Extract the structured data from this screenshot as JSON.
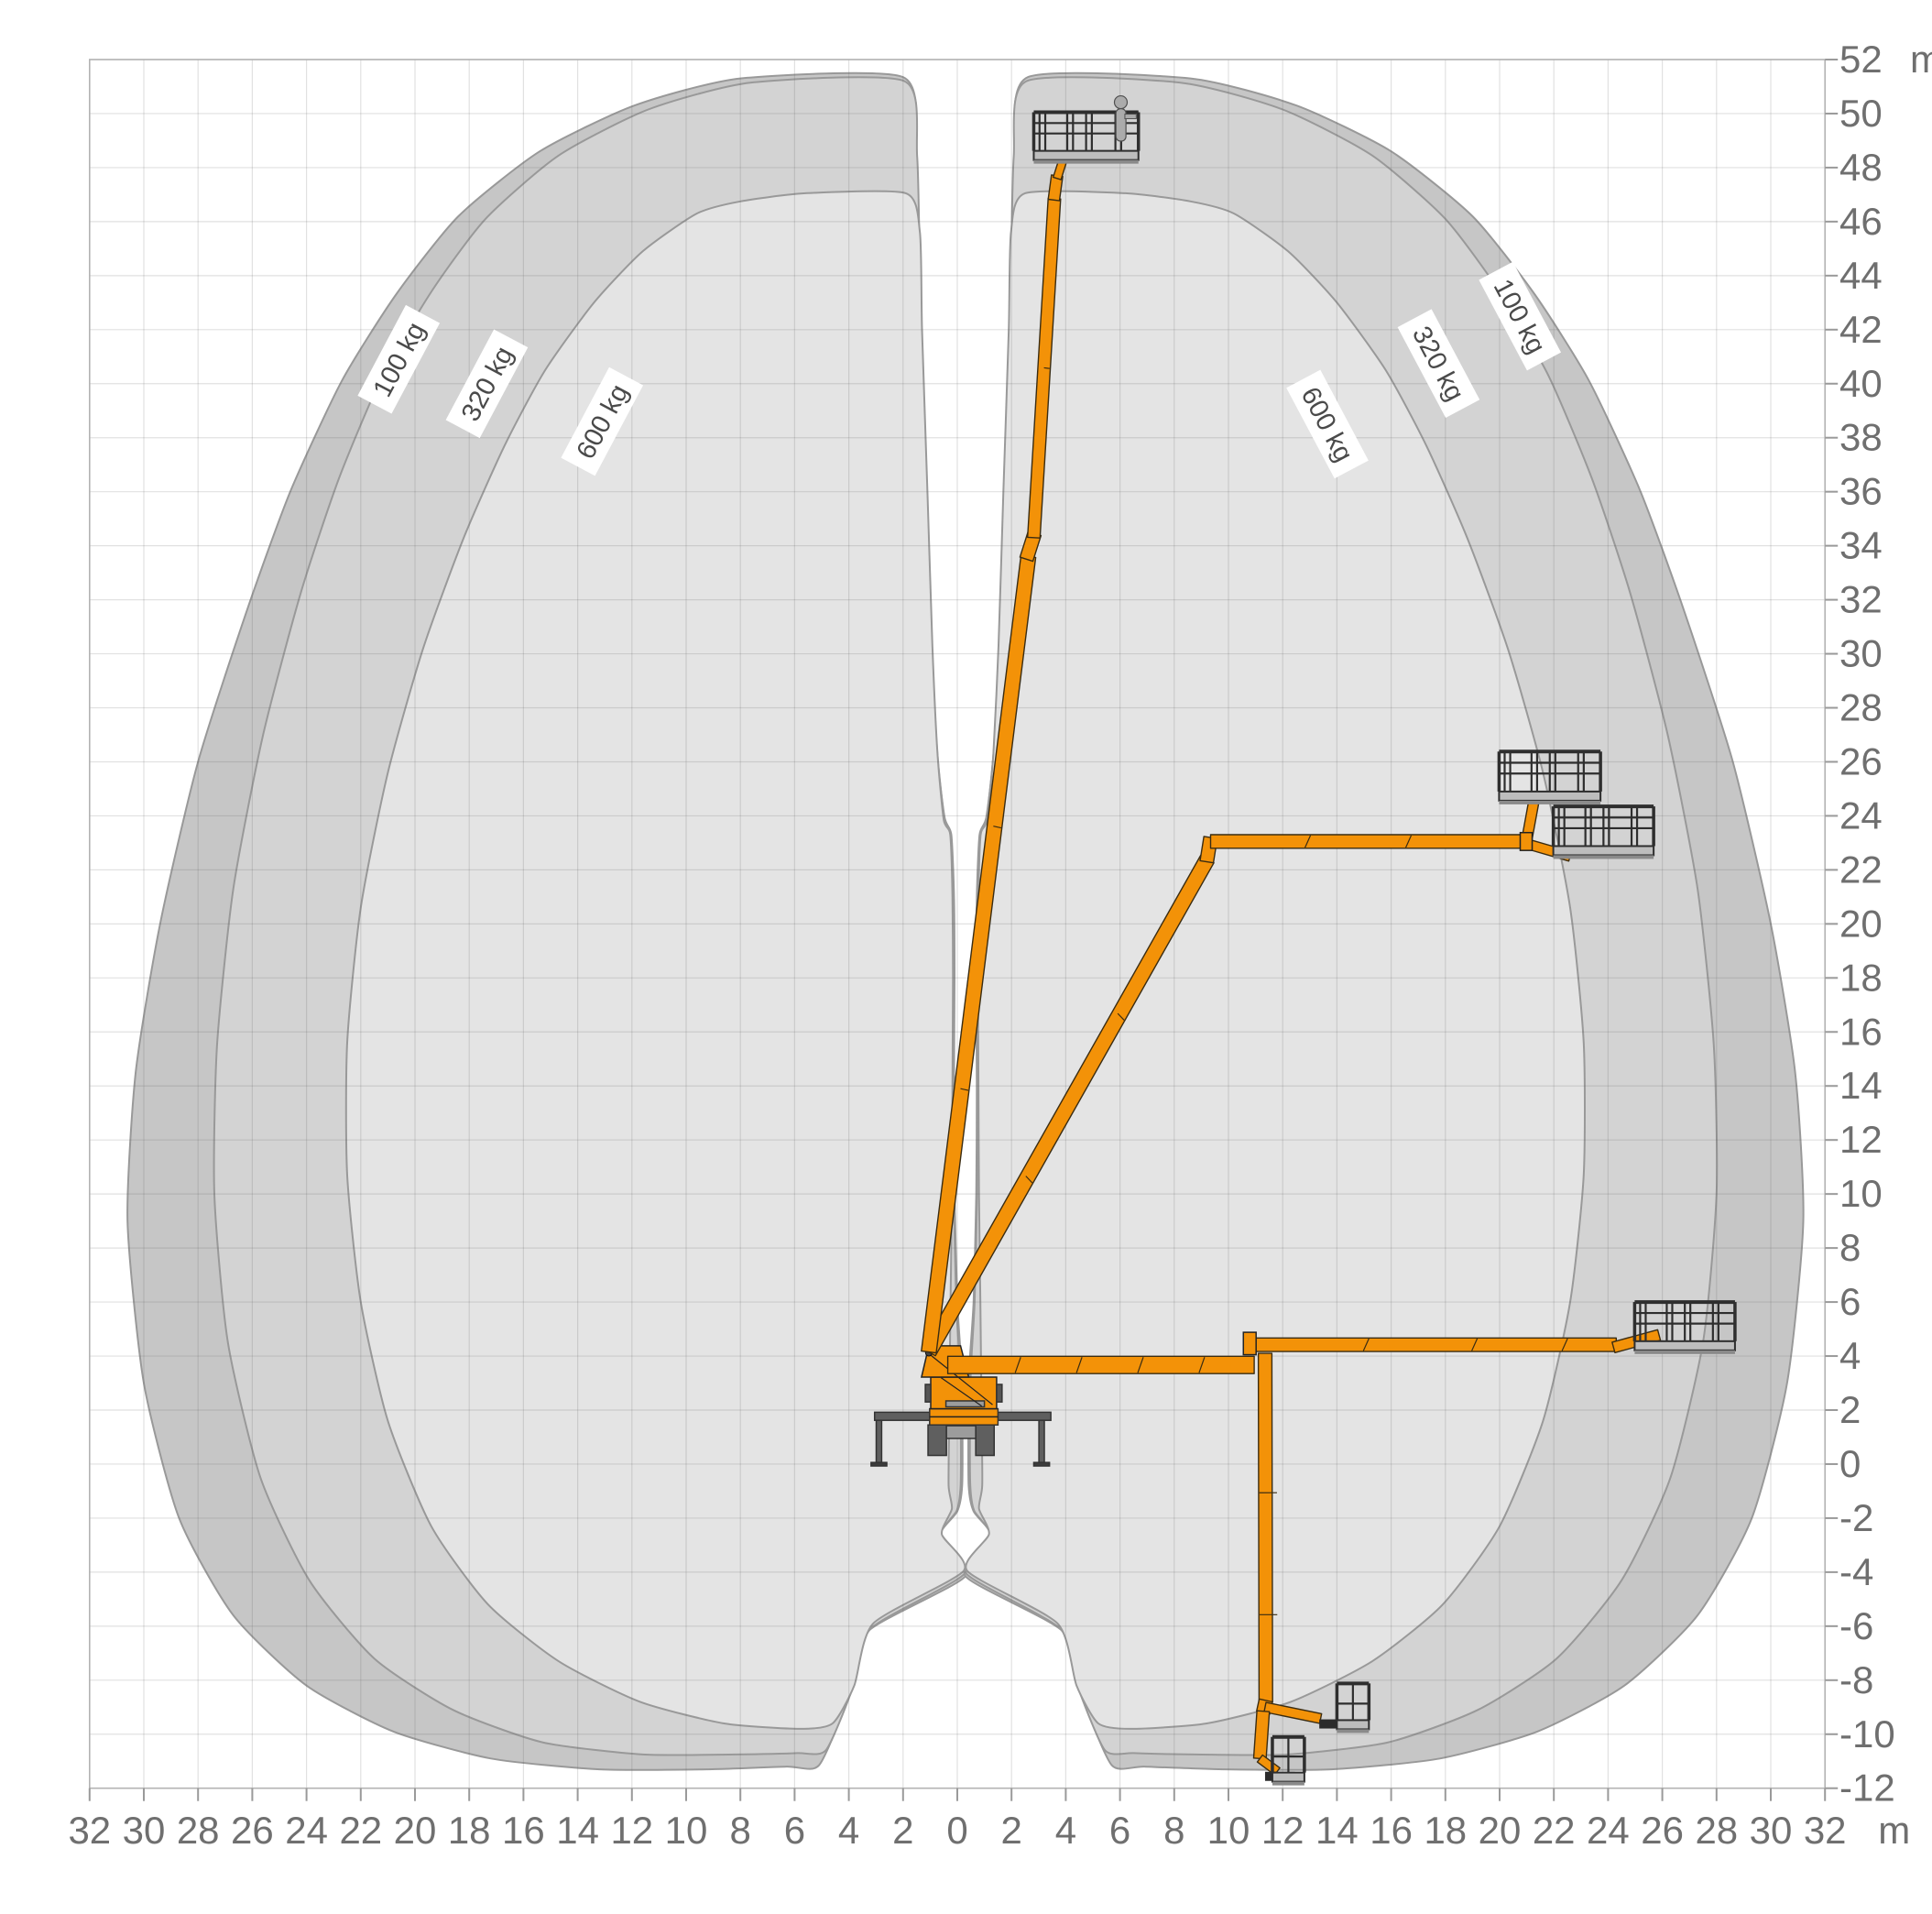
{
  "chart_data": {
    "type": "area",
    "title": "Working envelope diagram (truck-mounted aerial platform)",
    "x_axis": {
      "unit": "m",
      "min": -32,
      "max": 32,
      "step": 2,
      "tick_labels": [
        "32",
        "30",
        "28",
        "26",
        "24",
        "22",
        "20",
        "18",
        "16",
        "14",
        "12",
        "10",
        "8",
        "6",
        "4",
        "2",
        "0",
        "2",
        "4",
        "6",
        "8",
        "10",
        "12",
        "14",
        "16",
        "18",
        "20",
        "22",
        "24",
        "26",
        "28",
        "30",
        "32"
      ]
    },
    "y_axis": {
      "unit": "m",
      "min": -12,
      "max": 52,
      "step": 2,
      "tick_labels": [
        "52",
        "50",
        "48",
        "46",
        "44",
        "42",
        "40",
        "38",
        "36",
        "34",
        "32",
        "30",
        "28",
        "26",
        "24",
        "22",
        "20",
        "18",
        "16",
        "14",
        "12",
        "10",
        "8",
        "6",
        "4",
        "2",
        "0",
        "-2",
        "-4",
        "-6",
        "-8",
        "-10",
        "-12"
      ]
    },
    "grid": true,
    "mirror_axis_x": 0.3,
    "capacity_zones": [
      {
        "label": "100 kg",
        "color": "#c6c6c6",
        "max_outreach_m": 31.2,
        "max_height_m": 51.3,
        "min_depth_m": -11.3
      },
      {
        "label": "320 kg",
        "color": "#d3d3d3",
        "max_outreach_m": 28.0,
        "max_height_m": 51.2,
        "min_depth_m": -10.8
      },
      {
        "label": "600 kg",
        "color": "#e4e4e4",
        "max_outreach_m": 23.1,
        "max_height_m": 47.0,
        "min_depth_m": -9.8
      }
    ],
    "envelope_right_100": [
      [
        2.6,
        51.35
      ],
      [
        8.6,
        51.3
      ],
      [
        12.5,
        50.3
      ],
      [
        16,
        48.6
      ],
      [
        19,
        46.2
      ],
      [
        21.3,
        43.3
      ],
      [
        23.3,
        40.1
      ],
      [
        25.2,
        36
      ],
      [
        26.8,
        31.6
      ],
      [
        28.6,
        26
      ],
      [
        30.0,
        20
      ],
      [
        30.9,
        14.5
      ],
      [
        31.2,
        9
      ],
      [
        30.6,
        3
      ],
      [
        29.3,
        -2
      ],
      [
        27.3,
        -5.6
      ],
      [
        24.6,
        -8.2
      ],
      [
        21.4,
        -9.9
      ],
      [
        17.8,
        -10.9
      ],
      [
        13.8,
        -11.3
      ],
      [
        9.8,
        -11.3
      ],
      [
        6.9,
        -11.2
      ],
      [
        5.7,
        -11.15
      ],
      [
        4.6,
        -8.6
      ],
      [
        3.9,
        -6.2
      ],
      [
        0.3,
        -4.15
      ],
      [
        1.27,
        -2.7
      ],
      [
        0.6,
        -1.75
      ],
      [
        0.42,
        -0.8
      ],
      [
        0.41,
        1.5
      ],
      [
        0.44,
        3.5
      ],
      [
        0.6,
        6
      ],
      [
        0.7,
        10
      ],
      [
        0.72,
        14
      ],
      [
        0.7,
        18
      ],
      [
        0.72,
        21
      ],
      [
        0.82,
        23.3
      ],
      [
        1.07,
        23.95
      ],
      [
        1.37,
        26.5
      ],
      [
        1.58,
        30.5
      ],
      [
        1.78,
        36
      ],
      [
        1.98,
        43
      ],
      [
        2.1,
        48.5
      ]
    ],
    "envelope_right_320": [
      [
        2.55,
        51.2
      ],
      [
        8.2,
        51.15
      ],
      [
        12,
        50.15
      ],
      [
        15.3,
        48.45
      ],
      [
        18,
        46.1
      ],
      [
        20,
        43.4
      ],
      [
        21.8,
        40.3
      ],
      [
        23.4,
        36.5
      ],
      [
        24.8,
        32.3
      ],
      [
        26.2,
        27
      ],
      [
        27.3,
        21.3
      ],
      [
        27.9,
        15.5
      ],
      [
        28.0,
        10
      ],
      [
        27.5,
        4.5
      ],
      [
        26.3,
        -0.5
      ],
      [
        24.5,
        -4.3
      ],
      [
        22.1,
        -7.2
      ],
      [
        19.2,
        -9.1
      ],
      [
        15.9,
        -10.3
      ],
      [
        12.2,
        -10.75
      ],
      [
        8.8,
        -10.75
      ],
      [
        6.5,
        -10.7
      ],
      [
        5.45,
        -10.6
      ],
      [
        4.5,
        -8.4
      ],
      [
        3.8,
        -6.1
      ],
      [
        0.33,
        -4.05
      ],
      [
        1.22,
        -2.65
      ],
      [
        0.62,
        -1.72
      ],
      [
        0.48,
        -0.8
      ],
      [
        0.47,
        1.5
      ],
      [
        0.5,
        3.5
      ],
      [
        0.64,
        6
      ],
      [
        0.73,
        10
      ],
      [
        0.75,
        14
      ],
      [
        0.73,
        18
      ],
      [
        0.75,
        21
      ],
      [
        0.84,
        23.3
      ],
      [
        1.08,
        23.9
      ],
      [
        1.35,
        26.5
      ],
      [
        1.56,
        30.5
      ],
      [
        1.76,
        36
      ],
      [
        1.96,
        43
      ],
      [
        2.08,
        48.4
      ]
    ],
    "envelope_right_600": [
      [
        2.5,
        47.05
      ],
      [
        6.2,
        47.05
      ],
      [
        8.6,
        46.75
      ],
      [
        10.2,
        46.3
      ],
      [
        12.2,
        44.9
      ],
      [
        14.0,
        43
      ],
      [
        15.8,
        40.5
      ],
      [
        17.3,
        37.7
      ],
      [
        18.8,
        34.3
      ],
      [
        20.3,
        30.2
      ],
      [
        21.6,
        25.6
      ],
      [
        22.6,
        20.6
      ],
      [
        23.1,
        15.6
      ],
      [
        23.1,
        10.7
      ],
      [
        22.6,
        6
      ],
      [
        21.6,
        1.6
      ],
      [
        20.0,
        -2.3
      ],
      [
        17.9,
        -5.2
      ],
      [
        15.3,
        -7.3
      ],
      [
        12.3,
        -8.8
      ],
      [
        9.2,
        -9.6
      ],
      [
        6.4,
        -9.8
      ],
      [
        5.2,
        -9.6
      ],
      [
        4.4,
        -8.2
      ],
      [
        3.7,
        -5.9
      ],
      [
        0.36,
        -3.95
      ],
      [
        1.17,
        -2.6
      ],
      [
        0.8,
        -1.65
      ],
      [
        0.92,
        -0.8
      ],
      [
        0.9,
        1.5
      ],
      [
        0.88,
        3.5
      ],
      [
        0.85,
        6
      ],
      [
        0.8,
        10
      ],
      [
        0.78,
        14
      ],
      [
        0.76,
        18
      ],
      [
        0.78,
        21
      ],
      [
        0.86,
        23.3
      ],
      [
        1.1,
        23.85
      ],
      [
        1.33,
        26.3
      ],
      [
        1.52,
        30.3
      ],
      [
        1.7,
        36
      ],
      [
        1.9,
        42
      ],
      [
        1.98,
        45.6
      ]
    ],
    "zone_tags": [
      {
        "text": "100 kg",
        "x": -20.6,
        "y": 40.9,
        "rot": -62
      },
      {
        "text": "320 kg",
        "x": -17.35,
        "y": 40.0,
        "rot": -62
      },
      {
        "text": "600 kg",
        "x": -13.1,
        "y": 38.6,
        "rot": -62
      },
      {
        "text": "600 kg",
        "x": 13.65,
        "y": 38.5,
        "rot": 62
      },
      {
        "text": "320 kg",
        "x": 17.75,
        "y": 40.75,
        "rot": 62
      },
      {
        "text": "100 kg",
        "x": 20.75,
        "y": 42.5,
        "rot": 62
      }
    ]
  },
  "machine": {
    "boom_color": "#f39208",
    "boom_stroke": "#3a2c12",
    "links": [
      {
        "name": "lower-horizontal-boom",
        "from": [
          -0.35,
          3.67
        ],
        "to": [
          10.95,
          3.67
        ],
        "w": 0.64,
        "marks": [
          0.22,
          0.42,
          0.62,
          0.82
        ]
      },
      {
        "name": "outreach-stage-boom",
        "from": [
          10.98,
          4.42
        ],
        "to": [
          24.3,
          4.42
        ],
        "w": 0.5,
        "marks": [
          0.3,
          0.6,
          0.85
        ]
      },
      {
        "name": "outreach-tip-link",
        "from": [
          24.2,
          4.32
        ],
        "to": [
          25.88,
          4.78
        ],
        "w": 0.4,
        "marks": []
      },
      {
        "name": "down-boom-upper",
        "from": [
          11.35,
          4.1
        ],
        "to": [
          11.38,
          -8.8
        ],
        "w": 0.5,
        "marks": [
          0.4,
          0.75
        ]
      },
      {
        "name": "down-elbow",
        "from": [
          11.38,
          -8.75
        ],
        "to": [
          11.28,
          -9.2
        ],
        "w": 0.5,
        "marks": []
      },
      {
        "name": "down-jib",
        "from": [
          11.35,
          -9.0
        ],
        "to": [
          13.4,
          -9.42
        ],
        "w": 0.36,
        "marks": []
      },
      {
        "name": "down-boom-lower",
        "from": [
          11.28,
          -9.15
        ],
        "to": [
          11.16,
          -10.9
        ],
        "w": 0.46,
        "marks": []
      },
      {
        "name": "down-tip-link",
        "from": [
          11.16,
          -10.9
        ],
        "to": [
          11.8,
          -11.38
        ],
        "w": 0.32,
        "marks": []
      },
      {
        "name": "main-diagonal-boom",
        "from": [
          -1.05,
          4.15
        ],
        "to": [
          9.22,
          22.4
        ],
        "w": 0.56,
        "marks": [
          0.35,
          0.68
        ]
      },
      {
        "name": "diagonal-head",
        "from": [
          9.2,
          22.3
        ],
        "to": [
          9.34,
          23.2
        ],
        "w": 0.5,
        "marks": []
      },
      {
        "name": "upper-horizontal-boom",
        "from": [
          9.34,
          23.05
        ],
        "to": [
          20.95,
          23.05
        ],
        "w": 0.5,
        "marks": [
          0.3,
          0.62
        ]
      },
      {
        "name": "jib-up-link",
        "from": [
          21.0,
          23.1
        ],
        "to": [
          21.32,
          24.85
        ],
        "w": 0.38,
        "marks": []
      },
      {
        "name": "jib-down-link",
        "from": [
          21.05,
          22.95
        ],
        "to": [
          22.6,
          22.5
        ],
        "w": 0.36,
        "marks": []
      },
      {
        "name": "main-vertical-lower",
        "from": [
          -1.05,
          4.15
        ],
        "to": [
          2.62,
          33.6
        ],
        "w": 0.55,
        "marks": [
          0.33,
          0.66
        ]
      },
      {
        "name": "vertical-elbow",
        "from": [
          2.55,
          33.5
        ],
        "to": [
          2.85,
          34.45
        ],
        "w": 0.5,
        "marks": []
      },
      {
        "name": "main-vertical-upper",
        "from": [
          2.82,
          34.3
        ],
        "to": [
          3.58,
          46.85
        ],
        "w": 0.46,
        "marks": [
          0.5
        ]
      },
      {
        "name": "vertical-head",
        "from": [
          3.56,
          46.8
        ],
        "to": [
          3.68,
          47.7
        ],
        "w": 0.42,
        "marks": []
      },
      {
        "name": "vertical-platform-link",
        "from": [
          3.68,
          47.6
        ],
        "to": [
          3.98,
          48.55
        ],
        "w": 0.3,
        "marks": []
      }
    ],
    "jib_bracket": {
      "x1": 10.55,
      "y1": 4.05,
      "x2": 11.02,
      "y2": 4.88
    },
    "upper_joint": {
      "x1": 20.76,
      "y1": 22.72,
      "x2": 21.2,
      "y2": 23.38
    },
    "platforms": [
      {
        "name": "platform-max-height",
        "x1": 2.82,
        "x2": 6.68,
        "floor_y": 48.62,
        "rail_y": 50.05,
        "type": "large",
        "person": true,
        "mount": {
          "x1": 3.95,
          "x2": 5.75,
          "y": 48.45
        }
      },
      {
        "name": "platform-jib-up",
        "x1": 19.98,
        "x2": 23.72,
        "floor_y": 24.9,
        "rail_y": 26.38,
        "type": "large",
        "person": false,
        "mount": {
          "x1": 21.4,
          "x2": 23.1,
          "y": 24.7
        }
      },
      {
        "name": "platform-jib-down",
        "x1": 21.98,
        "x2": 25.68,
        "floor_y": 22.88,
        "rail_y": 24.35,
        "type": "large",
        "person": false,
        "mount": {
          "x1": 22.6,
          "x2": 24.2,
          "y": 22.62
        }
      },
      {
        "name": "platform-max-outreach",
        "x1": 24.98,
        "x2": 28.68,
        "floor_y": 4.55,
        "rail_y": 6.0,
        "type": "large",
        "person": false,
        "mount": {
          "x1": 25.3,
          "x2": 26.9,
          "y": 4.38
        }
      },
      {
        "name": "basket-below-grade-1",
        "x1": 14.0,
        "x2": 15.18,
        "floor_y": -9.48,
        "rail_y": -8.12,
        "type": "small",
        "person": false,
        "mount": {
          "x1": 13.35,
          "x2": 14.55,
          "y": -9.62
        }
      },
      {
        "name": "basket-below-grade-2",
        "x1": 11.62,
        "x2": 12.8,
        "floor_y": -11.42,
        "rail_y": -10.1,
        "type": "small",
        "person": false,
        "mount": {
          "x1": 11.35,
          "x2": 12.45,
          "y": -11.56
        }
      }
    ],
    "truck": {
      "body_color": "#f39208",
      "steel_color": "#5f5f5f",
      "light_color": "#9c9c9c",
      "outrigger_beam": {
        "x1": -3.05,
        "y1": 1.62,
        "x2": 3.45,
        "y2": 1.92
      },
      "legs": [
        {
          "x": -2.89,
          "w": 0.2
        },
        {
          "x": 3.11,
          "w": 0.2
        }
      ],
      "leg_top": 1.62,
      "leg_bottom": 0.06,
      "pad_w": 0.58,
      "pad_h": 0.13,
      "wheels": [
        {
          "x1": -1.08,
          "x2": -0.4
        },
        {
          "x1": 0.68,
          "x2": 1.36
        }
      ],
      "wheel_top": 1.45,
      "wheel_bottom": 0.32,
      "axle": {
        "x1": -0.4,
        "y1": 0.95,
        "x2": 0.68,
        "y2": 1.42
      },
      "skirt": {
        "x1": -1.02,
        "y1": 1.45,
        "x2": 1.5,
        "y2": 2.05
      },
      "turret": {
        "x1": -0.98,
        "y1": 2.05,
        "x2": 1.45,
        "y2": 3.22
      },
      "turret_slab": {
        "x1": -0.42,
        "y1": 2.12,
        "x2": 1.0,
        "y2": 2.34
      },
      "side_blocks": [
        {
          "x1": -1.18,
          "x2": -0.98
        },
        {
          "x1": 1.45,
          "x2": 1.65
        }
      ],
      "side_block_y": {
        "y1": 2.3,
        "y2": 2.95
      },
      "mast": [
        [
          -1.32,
          3.22
        ],
        [
          0.42,
          3.22
        ],
        [
          0.12,
          4.38
        ],
        [
          -1.05,
          4.38
        ]
      ],
      "pivot": {
        "x": -1.05,
        "y": 4.12,
        "r": 0.12
      }
    }
  },
  "style": {
    "grid_color": "rgba(90,90,90,0.18)",
    "frame_color": "#b3b3b3",
    "tick_color": "#9a9a9a",
    "label_color": "#6f6f6f",
    "tag_text_color": "#4a4a4a",
    "envelope_stroke": "#999999",
    "basket_dark": "#2e2e2e",
    "basket_light": "#bdbdbd",
    "person_fill": "#ababab",
    "person_stroke": "#4f4f4f"
  }
}
